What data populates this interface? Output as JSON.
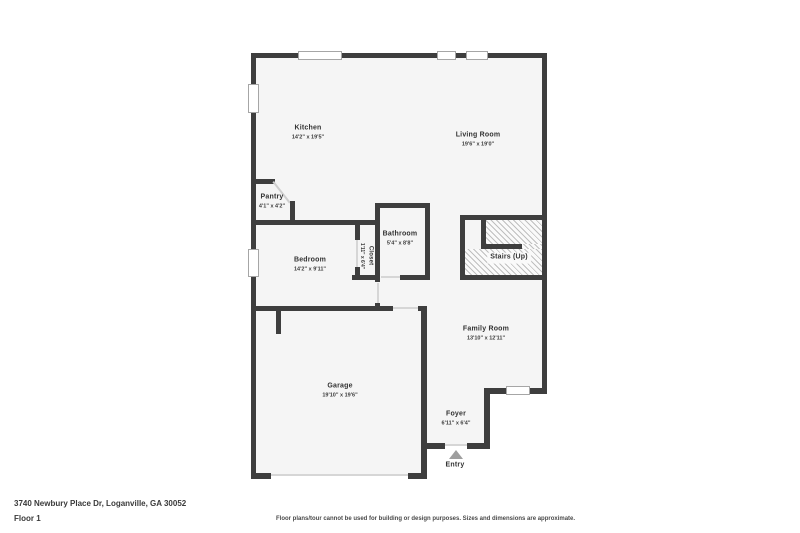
{
  "footer": {
    "address": "3740 Newbury Place Dr, Loganville, GA 30052",
    "floor_label": "Floor 1",
    "disclaimer": "Floor plans/tour cannot be used for building or design purposes. Sizes and dimensions are approximate."
  },
  "colors": {
    "wall": "#3e3e3e",
    "floor": "#f5f5f5",
    "stair_hatch": "#bfbfbf",
    "window_border": "#a6a6a6",
    "door_line": "#d6d6d6",
    "entry_arrow": "#9e9e9e",
    "label_text": "#323232"
  },
  "rooms": [
    {
      "id": "kitchen",
      "name": "Kitchen",
      "dims": "14'2\" x 19'5\""
    },
    {
      "id": "living-room",
      "name": "Living Room",
      "dims": "19'6\" x 19'0\""
    },
    {
      "id": "pantry",
      "name": "Pantry",
      "dims": "4'1\" x 4'2\""
    },
    {
      "id": "bedroom",
      "name": "Bedroom",
      "dims": "14'2\" x 9'11\""
    },
    {
      "id": "closet",
      "name": "Closet",
      "dims": "1'11\" x 6'4\""
    },
    {
      "id": "bathroom",
      "name": "Bathroom",
      "dims": "5'4\" x 8'8\""
    },
    {
      "id": "stairs",
      "name": "Stairs (Up)",
      "dims": ""
    },
    {
      "id": "family-room",
      "name": "Family Room",
      "dims": "13'10\" x 12'11\""
    },
    {
      "id": "garage",
      "name": "Garage",
      "dims": "19'10\" x 19'6\""
    },
    {
      "id": "foyer",
      "name": "Foyer",
      "dims": "6'11\" x 6'4\""
    },
    {
      "id": "entry",
      "name": "Entry",
      "dims": ""
    }
  ]
}
